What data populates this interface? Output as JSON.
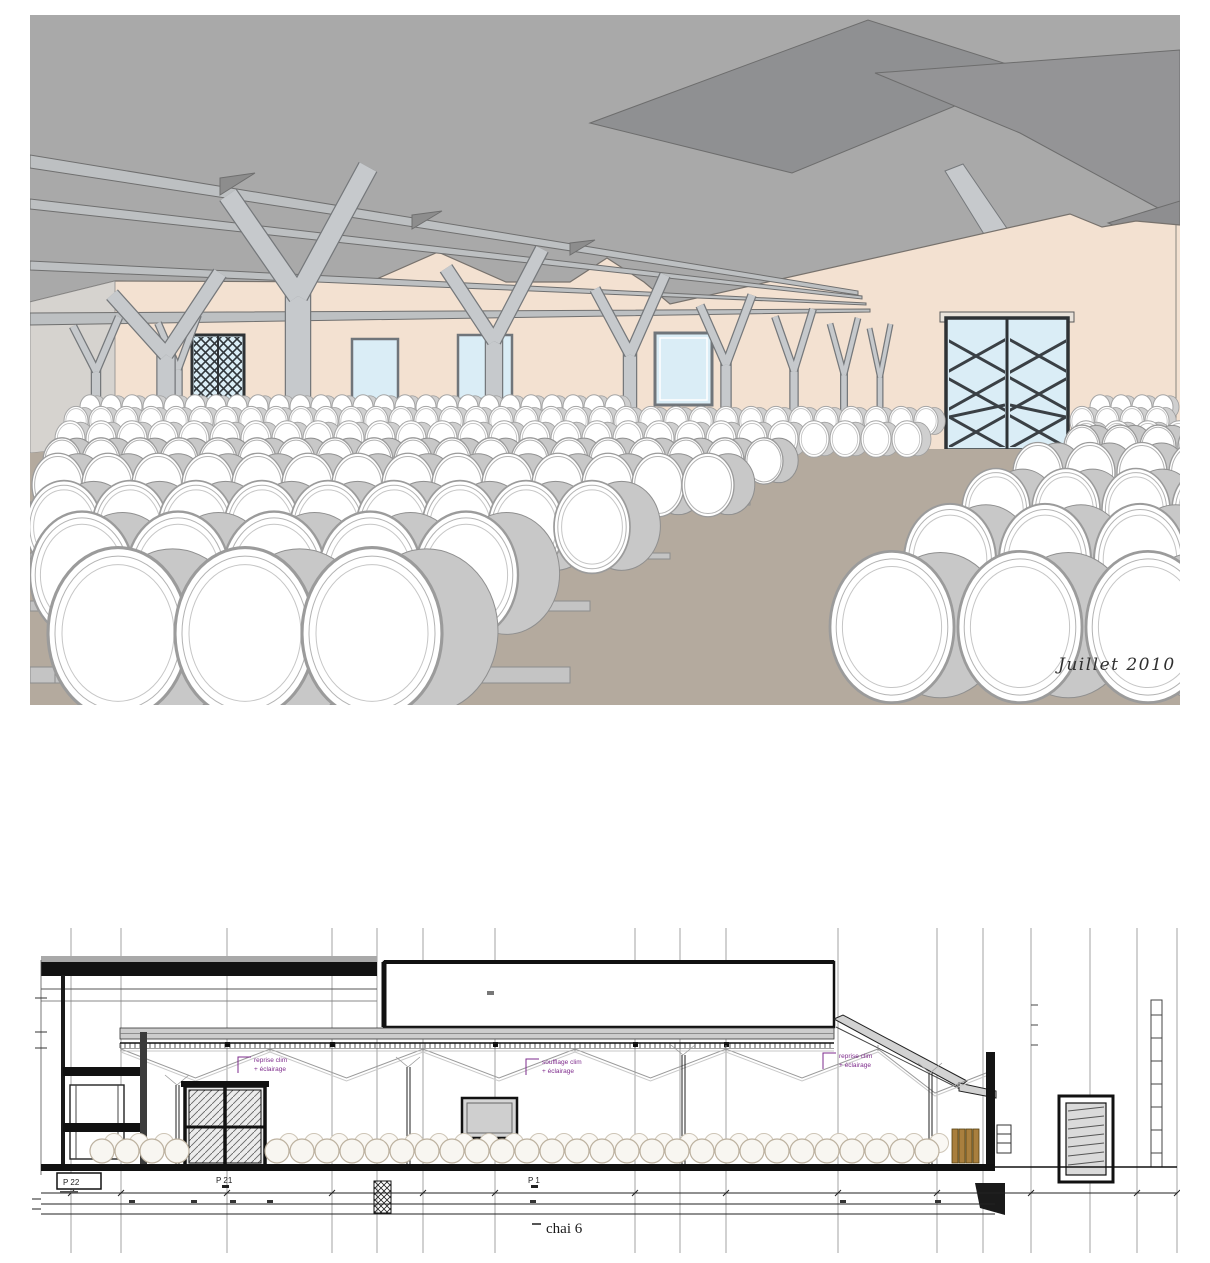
{
  "render": {
    "caption": "Juillet 2010",
    "colors": {
      "ceiling": "#a9a9a9",
      "roof_dark": "#8f9092",
      "beam": "#bdc0c2",
      "beam_edge": "#6f6f6f",
      "column": "#c6c9cc",
      "column_edge": "#75787b",
      "wall": "#f3e1d1",
      "wall_left": "#d6d3cf",
      "floor": "#b4aa9e",
      "window": "#daedf6",
      "door_frame": "#2e3235",
      "barrel_face": "#ffffff",
      "barrel_body": "#c8c8c8",
      "barrel_rim": "#9b9b9b",
      "rail": "#c4c4c4",
      "rail_edge": "#8d8d8d"
    }
  },
  "section": {
    "labels": {
      "pier_box": "P 22",
      "pier_21": "P 21",
      "pier_1": "P 1",
      "title": "chai 6"
    },
    "annotations": [
      {
        "line1": "reprise clim",
        "line2": "+ éclairage"
      },
      {
        "line1": "soufflage clim",
        "line2": "+ éclairage"
      },
      {
        "line1": "reprise clim",
        "line2": "+ éclairage"
      }
    ],
    "colors": {
      "annotation": "#7e2b8c",
      "ink": "#141414",
      "grid": "#999999",
      "fill_gray": "#cdcdcd",
      "barrel_row": "#bdb2a0",
      "stack_brown": "#a97f3e"
    }
  }
}
